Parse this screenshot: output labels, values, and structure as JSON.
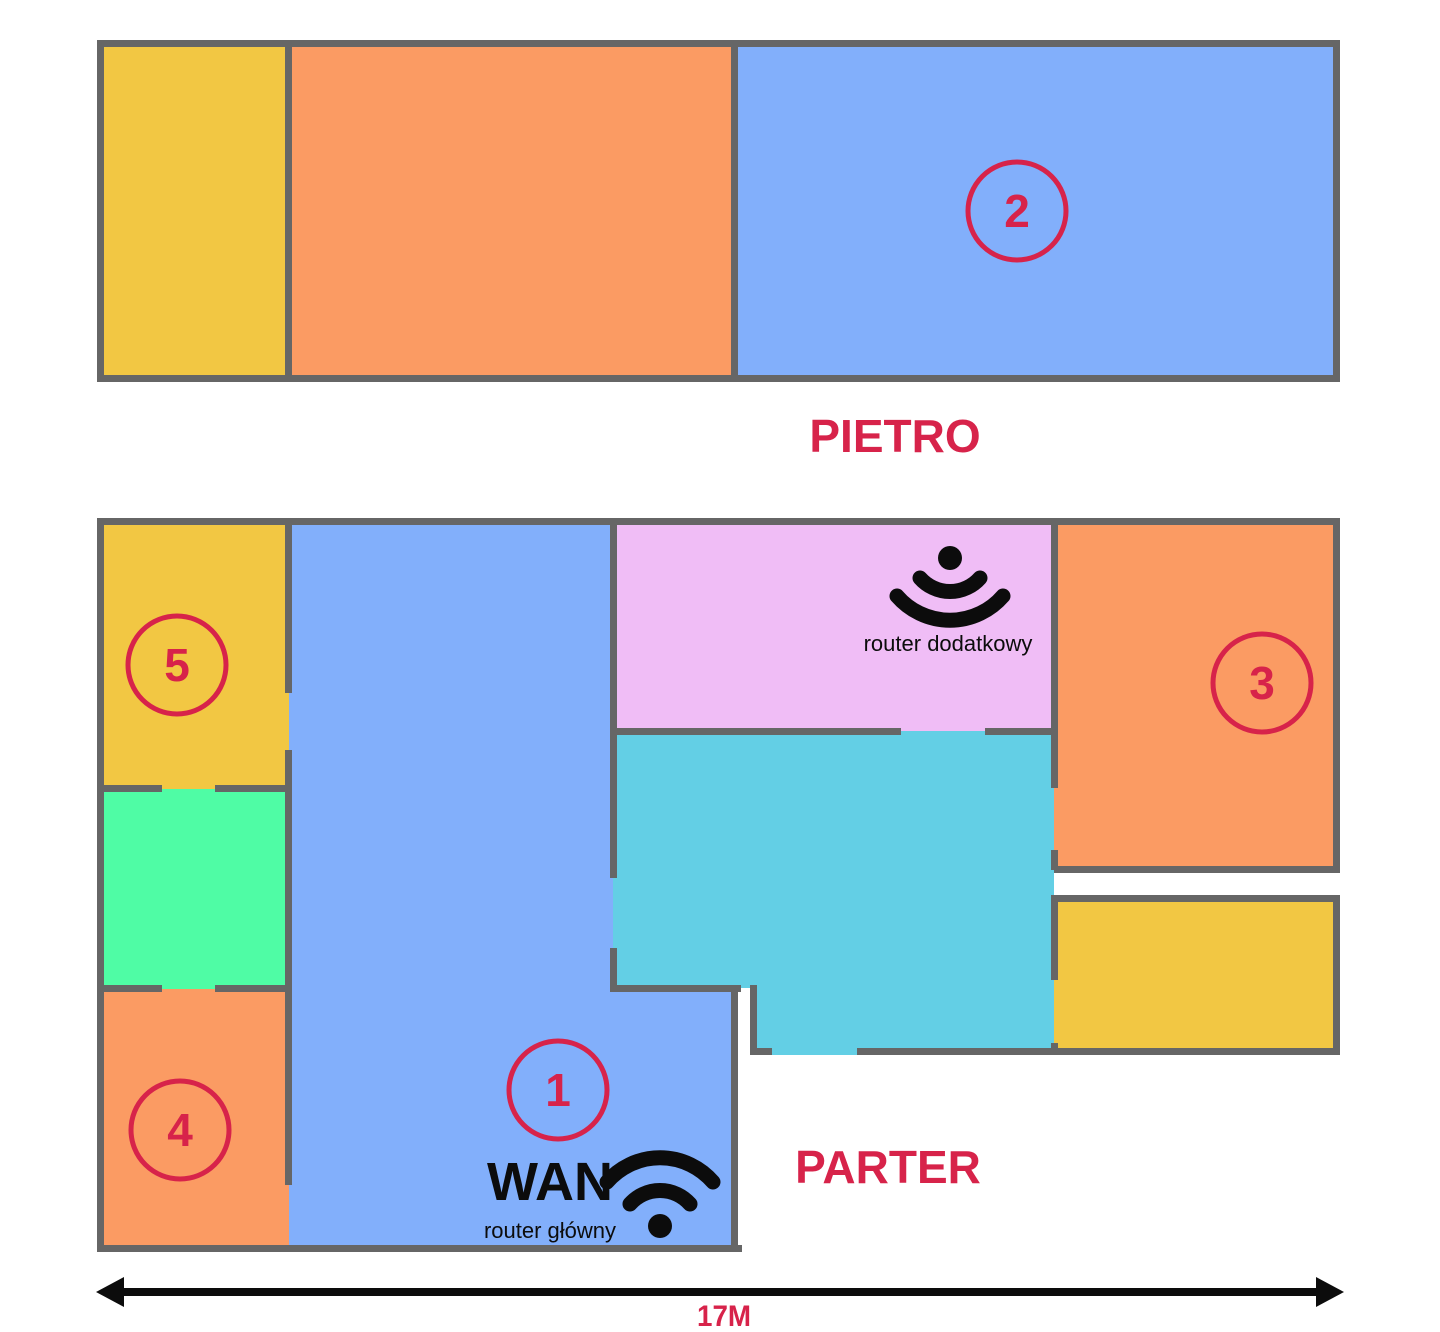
{
  "colors": {
    "wall": "#666666",
    "accent": "#D7234A",
    "ink": "#0c0c0c",
    "yellow": "#F2C743",
    "orange": "#FB9B63",
    "blue": "#82AFFB",
    "pink": "#F0BDF6",
    "cyan": "#63CFE5",
    "green": "#4FFCA5"
  },
  "floors": {
    "upper": {
      "label": "PIETRO"
    },
    "ground": {
      "label": "PARTER"
    }
  },
  "labels": {
    "wan": "WAN",
    "main_router": "router główny",
    "secondary_router": "router dodatkowy",
    "dimension": "17M"
  },
  "markers": [
    {
      "number": "1",
      "cx": 558,
      "cy": 1090,
      "r": 49
    },
    {
      "number": "2",
      "cx": 1017,
      "cy": 211,
      "r": 49
    },
    {
      "number": "3",
      "cx": 1262,
      "cy": 683,
      "r": 49
    },
    {
      "number": "4",
      "cx": 180,
      "cy": 1130,
      "r": 49
    },
    {
      "number": "5",
      "cx": 177,
      "cy": 665,
      "r": 49
    }
  ],
  "rooms": [
    {
      "name": "upper-left-yellow",
      "color": "yellow",
      "rect": [
        100,
        43,
        189,
        336
      ]
    },
    {
      "name": "upper-middle-orange",
      "color": "orange",
      "rect": [
        289,
        43,
        446,
        336
      ]
    },
    {
      "name": "upper-right-blue-room-2",
      "color": "blue",
      "rect": [
        735,
        43,
        602,
        336
      ]
    },
    {
      "name": "room-5-yellow",
      "color": "yellow",
      "rect": [
        100,
        521,
        189,
        268
      ]
    },
    {
      "name": "left-green-room",
      "color": "green",
      "rect": [
        100,
        789,
        189,
        200
      ]
    },
    {
      "name": "room-4-orange",
      "color": "orange",
      "rect": [
        100,
        989,
        189,
        260
      ]
    },
    {
      "name": "hall-blue-room-1",
      "color": "blue",
      "points": "289,521 613,521 613,988 734,988 734,1249 289,1249"
    },
    {
      "name": "pink-router-room",
      "color": "pink",
      "rect": [
        613,
        521,
        441,
        211
      ]
    },
    {
      "name": "cyan-room",
      "color": "cyan",
      "points": "613,731 1054,731 1054,1055 753,1055 753,988 613,988"
    },
    {
      "name": "room-3-orange",
      "color": "orange",
      "rect": [
        1054,
        521,
        283,
        348
      ]
    },
    {
      "name": "bottom-right-yellow",
      "color": "yellow",
      "rect": [
        1054,
        898,
        283,
        157
      ]
    }
  ],
  "walls": [
    [
      97,
      40,
      1243,
      7
    ],
    [
      97,
      375,
      1243,
      7
    ],
    [
      97,
      40,
      7,
      342
    ],
    [
      1333,
      40,
      7,
      342
    ],
    [
      285,
      40,
      7,
      342
    ],
    [
      731,
      40,
      7,
      342
    ],
    [
      97,
      518,
      1243,
      7
    ],
    [
      97,
      518,
      7,
      734
    ],
    [
      97,
      1245,
      645,
      7
    ],
    [
      1333,
      518,
      7,
      355
    ],
    [
      1054,
      866,
      286,
      7
    ],
    [
      1051,
      895,
      289,
      7
    ],
    [
      1333,
      895,
      7,
      160
    ],
    [
      857,
      1048,
      483,
      7
    ],
    [
      750,
      1048,
      22,
      7
    ],
    [
      285,
      518,
      7,
      175
    ],
    [
      285,
      750,
      7,
      435
    ],
    [
      97,
      785,
      65,
      7
    ],
    [
      215,
      785,
      77,
      7
    ],
    [
      97,
      985,
      65,
      7
    ],
    [
      215,
      985,
      77,
      7
    ],
    [
      610,
      518,
      7,
      360
    ],
    [
      610,
      948,
      7,
      44
    ],
    [
      610,
      985,
      131,
      7
    ],
    [
      731,
      985,
      7,
      267
    ],
    [
      750,
      985,
      7,
      70
    ],
    [
      610,
      728,
      291,
      7
    ],
    [
      985,
      728,
      70,
      7
    ],
    [
      1051,
      518,
      7,
      270
    ],
    [
      1051,
      850,
      7,
      20
    ],
    [
      1051,
      895,
      7,
      85
    ],
    [
      1051,
      1043,
      7,
      12
    ]
  ]
}
